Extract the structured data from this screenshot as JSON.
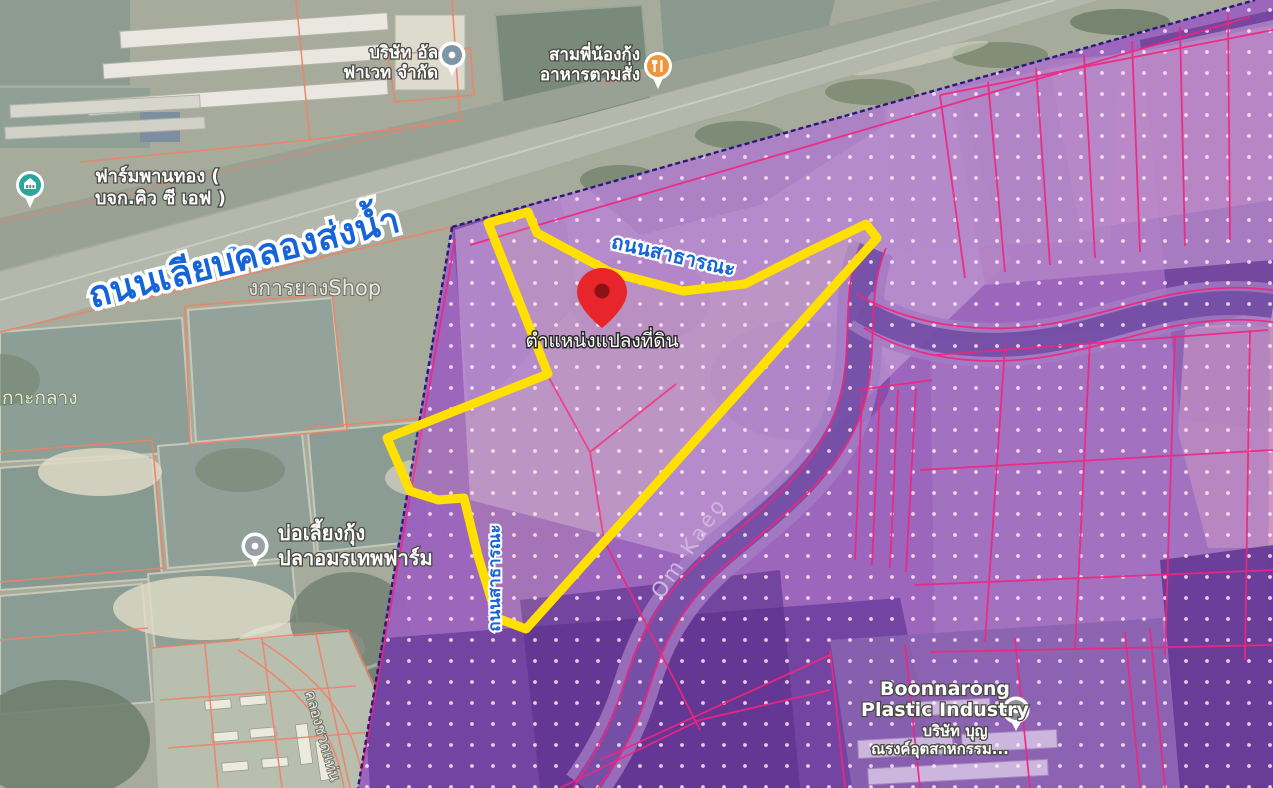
{
  "map": {
    "type": "satellite-with-zoning-overlay",
    "pin_label": "ตำแหน่งแปลงที่ดิน",
    "road_labels": {
      "canal_road": "ถนนเลียบคลองส่งน้ำ",
      "public_road_top": "ถนนสาธารณะ",
      "public_road_west": "ถนนสาธารณะ",
      "khlong_road": "คลองชวดแท่น"
    },
    "waterway_label": "Om Kaeo",
    "area_labels": {
      "island": "กาะกลาง",
      "rubber_shop": "งการยางShop"
    },
    "pois": {
      "alfavet_company": {
        "line1": "บริษัท อัล",
        "line2": "ฟาเวท จำกัด",
        "icon": "office-pin"
      },
      "restaurant": {
        "line1": "สามพี่น้องกุ้ง",
        "line2": "อาหารตามสั่ง",
        "icon": "restaurant-pin"
      },
      "panthong_farm": {
        "line1": "ฟาร์มพานทอง (",
        "line2": "บจก.คิว ซี เอฟ )",
        "icon": "farm-pin"
      },
      "shrimp_farm": {
        "line1": "บ่อเลี้ยงกุ้ง",
        "line2": "ปลาอมรเทพฟาร์ม",
        "icon": "generic-pin"
      },
      "factory": {
        "line1": "Boonnarong",
        "line2": "Plastic Industry",
        "line3": "บริษัท บุญ",
        "line4": "ณรงค์อุตสาหกรรม...",
        "icon": "generic-pin"
      }
    },
    "colors": {
      "zone_overlay_purple": "#9a63bd",
      "parcel_line_pink": "#f0257f",
      "plot_outline_yellow": "#ffe000",
      "road_label_blue": "#1565d8",
      "pin_red": "#e8252b",
      "satellite_parcel_line": "#ef8268"
    }
  }
}
